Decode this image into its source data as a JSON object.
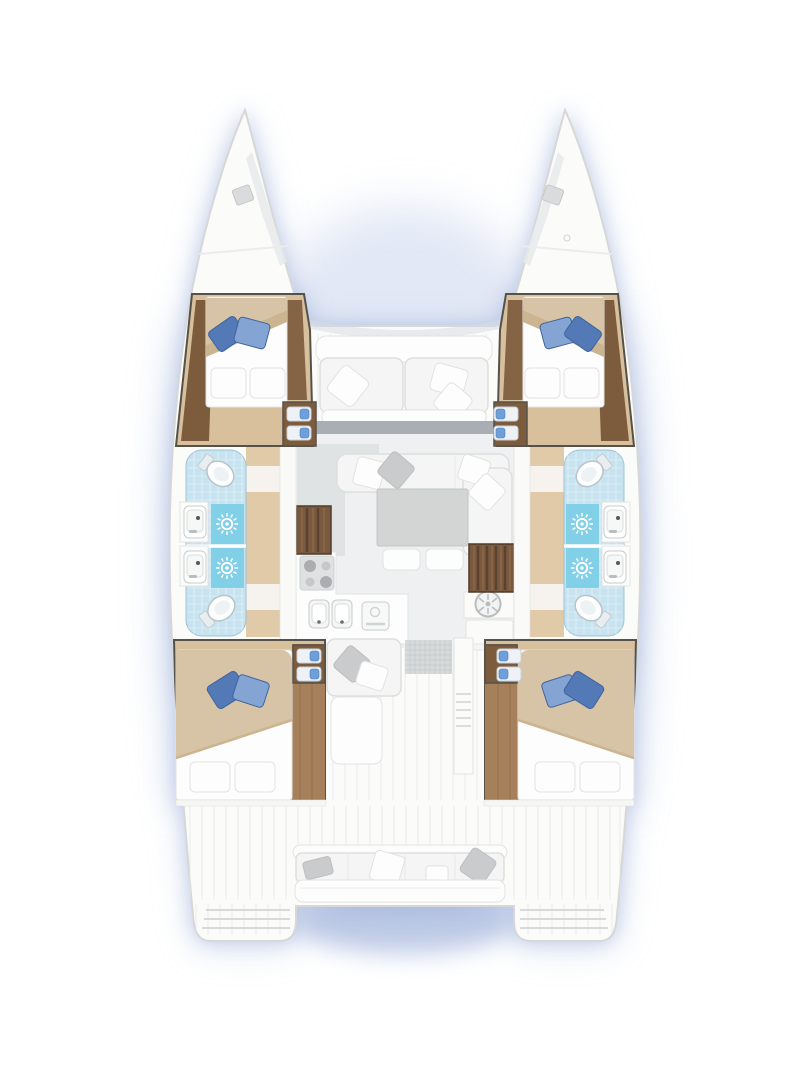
{
  "page": {
    "title": "Catamaran accommodation floor plan, top view, bows up",
    "background": "#ffffff"
  },
  "vessel": {
    "type": "sailing catamaran deck and cabin layout",
    "hulls": 2,
    "berth_count": 4,
    "toilet_count": 4,
    "shower_count": 4,
    "washbasin_count": 4,
    "cabin_steps_units": 4,
    "companionway_stairs": 2
  },
  "labels": {
    "boat": "Catamaran floor plan",
    "port_bow": "Port bow deck with hatch",
    "starboard_bow": "Starboard bow deck with hatch",
    "forward_cockpit": "Forward cockpit bench with cushions and pillows",
    "windshield": "Salon front windshield",
    "salon": "Salon with U-shaped sofa and table",
    "galley": "Galley with 4-burner stove, double sink and oven",
    "nav_area": "Aft-starboard utility area with round appliance",
    "port_stairs": "Port hull companionway stairs",
    "starboard_stairs": "Starboard hull companionway stairs",
    "port_forward_cabin": "Port forward cabin with double berth and blue pillows",
    "starboard_forward_cabin": "Starboard forward cabin with double berth and blue pillows",
    "port_bathrooms": "Port hull bathrooms: two toilets, two showers, two washbasins",
    "starboard_bathrooms": "Starboard hull bathrooms: two toilets, two showers, two washbasins",
    "port_aft_cabin": "Port aft cabin with double berth and blue pillows",
    "starboard_aft_cabin": "Starboard aft cabin with double berth and blue pillows",
    "aft_cockpit": "Aft cockpit with seat, grating, table and ladder",
    "stern_bench": "Stern bench with cushions and pillows",
    "port_transom": "Port transom swim steps",
    "starboard_transom": "Starboard transom swim steps"
  },
  "icon_legend": [
    {
      "icon": "shower-rose-icon",
      "meaning": "shower head (white sunburst on blue tray)"
    },
    {
      "icon": "toilet-icon",
      "meaning": "marine toilet"
    },
    {
      "icon": "washbasin-icon",
      "meaning": "washbasin with faucet"
    },
    {
      "icon": "stove-burners-icon",
      "meaning": "4-burner galley stove"
    },
    {
      "icon": "round-appliance-icon",
      "meaning": "round spoked appliance"
    },
    {
      "icon": "stairs-icon",
      "meaning": "companionway steps down into hull"
    }
  ],
  "colors": {
    "deck": "#fbfbfa",
    "hull-stroke": "#d6d7d6",
    "wall": "#55514b",
    "wood": "#d9c09c",
    "wood-light": "#e0caa8",
    "wood-mid": "#a5805a",
    "wood-dark": "#7d5c3d",
    "stairs": "#7a5a3e",
    "stairs-line": "#5a4130",
    "tile": "#c6e3ef",
    "shower": "#82cfe8",
    "bed-beige": "#d7c3a5",
    "bed-beige-shade": "#cbb591",
    "pillow-blue-dark": "#5379b6",
    "pillow-blue-light": "#84a4d4",
    "pillow-blue-stroke": "#3f639c",
    "sofa-white": "#f4f5f4",
    "sofa-stroke": "#dededc",
    "cushion-gray": "#c9cbcc",
    "table-gray": "#d3d5d5",
    "floor-salon": "#eef0f1",
    "floor-cockpit": "#ecedee",
    "plank-line": "#e3e5e5",
    "window-gray": "#a9aeb5",
    "grate": "#d7dadb",
    "grate-line": "#c6cacb",
    "appliance": "#e0e2e2",
    "step-blue": "#6f9fd8",
    "glow-blue": "#8ca2d4"
  }
}
